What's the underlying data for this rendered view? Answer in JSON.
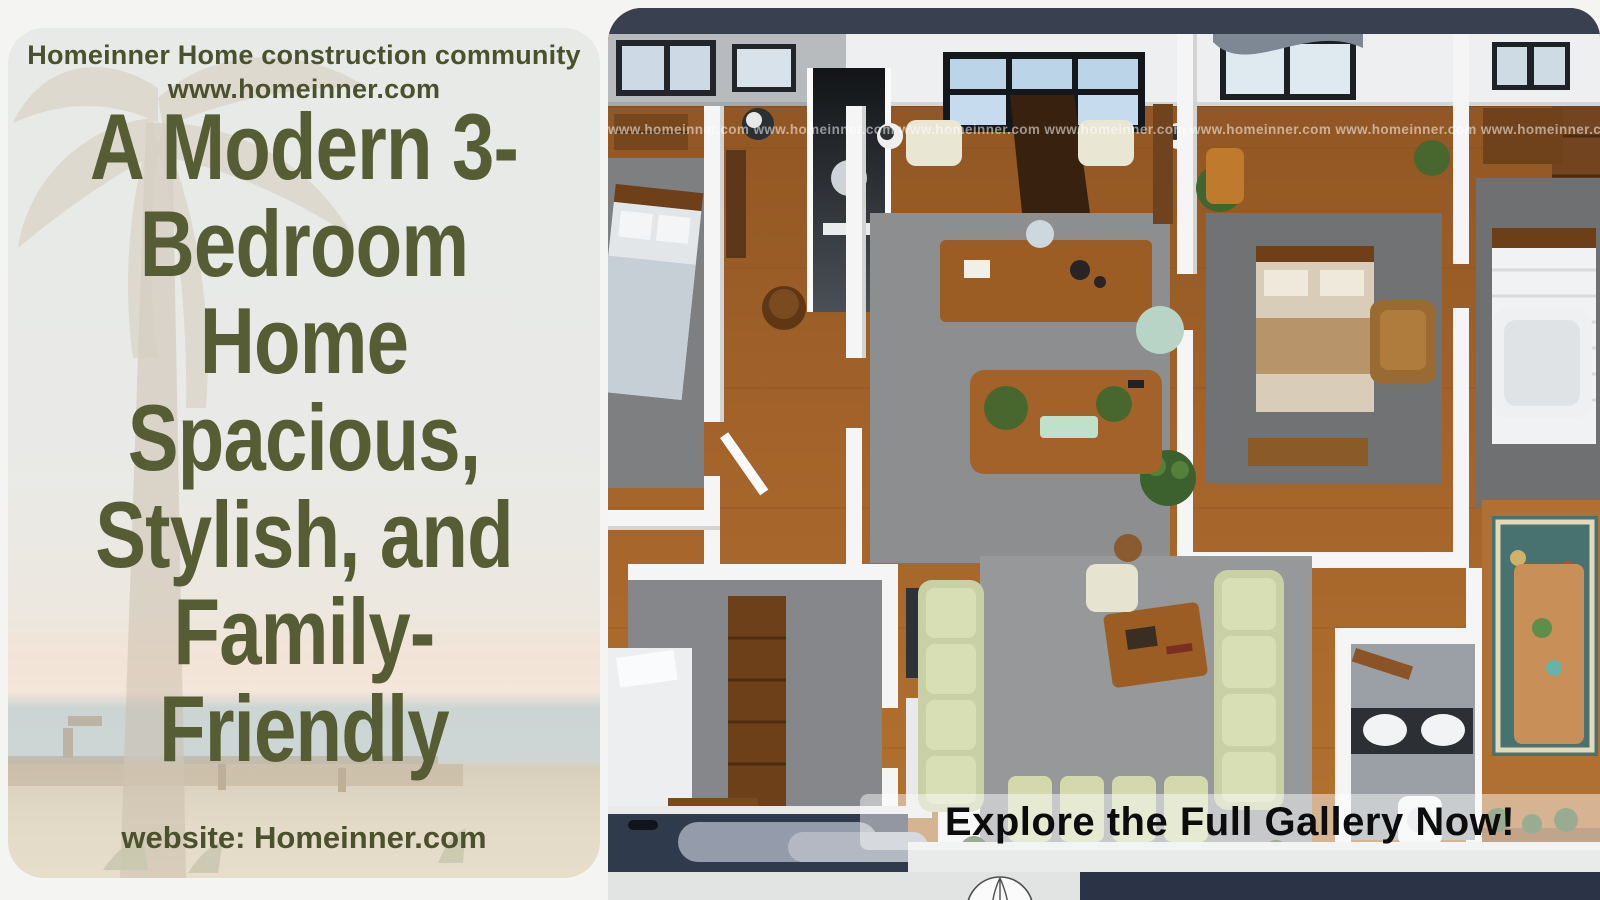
{
  "brand": {
    "header_line1": "Homeinner Home construction community",
    "header_line2": "www.homeinner.com",
    "footer": "website: Homeinner.com"
  },
  "headline": {
    "lines": [
      "A Modern 3-",
      "Bedroom",
      "Home",
      "Spacious,",
      "Stylish, and",
      "Family-",
      "Friendly"
    ]
  },
  "floor_plan": {
    "watermark": "www.homeinner.com www.homeinner.com www.homeinner.com www.homeinner.com www.homeinner.com www.homeinner.com www.homeinner.com www.homeinner.com www.homeinner.com www.homeinner.com",
    "cta": "Explore the Full Gallery Now!"
  },
  "colors": {
    "headline_green": "#565c33",
    "header_green": "#4a512c",
    "navy_bar": "#39404f",
    "navy_bottom": "#2b3446",
    "wood_floor": "#a0602a",
    "wall_white": "#f4f5f4",
    "rug_gray": "#8b8d8f",
    "sofa_sage": "#ccd3a9",
    "cta_text": "#0c0c0c",
    "watermark_white": "rgba(255,255,255,0.52)"
  }
}
